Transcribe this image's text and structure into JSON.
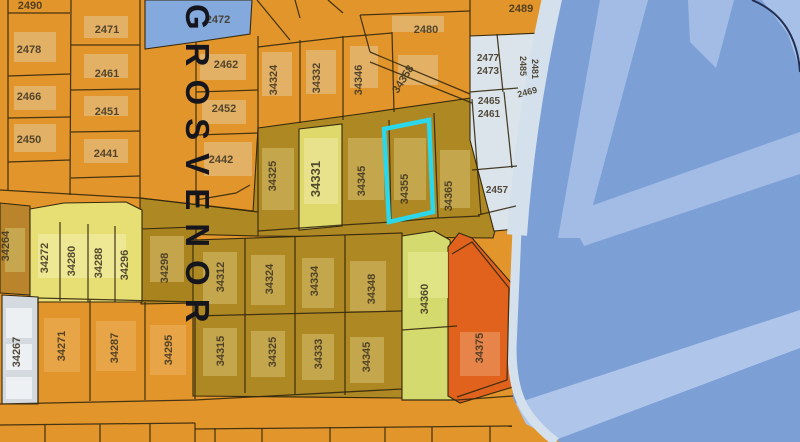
{
  "map": {
    "title": "Parcel map with selected parcel 34355",
    "selected_parcel": "34355",
    "highlight": {
      "points": "384,129 429,120 433,212 389,222",
      "color": "#2BD7EA",
      "width": 4.5
    },
    "street_label": {
      "text": "GROSVENOR",
      "x": 158,
      "y": 4,
      "size": 33
    },
    "colors": {
      "water": "#7CA0D6",
      "road_light": "#D4E1ED",
      "band": "#A2BCE6",
      "band2": "#AFC6EA",
      "orange": "#E2952A",
      "olive": "#AE8822",
      "olive_dark": "#A9831E",
      "brown": "#B9842B",
      "yellow": "#E7DF74",
      "yellow2": "#DFD96B",
      "yellow_green": "#D5DA6F",
      "red": "#E0621C",
      "light_parcel": "#DBE4EB",
      "gray_parcel": "#D5DAE0",
      "blue_parcel": "#84A9DC",
      "line": "#35290F"
    },
    "regions": [
      {
        "name": "region-water",
        "points": "0,0 800,0 800,442 0,442",
        "fill": "#7CA0D6",
        "stroke": "none"
      },
      {
        "name": "highway-band",
        "points": "600,0 648,0 584,238 558,238",
        "fill": "#A2BCE6",
        "stroke": "none"
      },
      {
        "name": "highway-band",
        "points": "800,132 800,174 584,246 568,214",
        "fill": "#A2BCE6",
        "stroke": "none"
      },
      {
        "name": "highway-band",
        "points": "688,0 734,0 716,68 690,42",
        "fill": "#A2BCE6",
        "stroke": "none"
      },
      {
        "name": "highway-band",
        "points": "762,0 800,0 800,70 788,34",
        "fill": "#A6C0E8",
        "stroke": "none"
      },
      {
        "name": "highway-band",
        "points": "514,404 800,310 800,348 550,442 518,430",
        "fill": "#AFC6EA",
        "stroke": "none"
      },
      {
        "name": "region-land",
        "points": "0,0 550,0 542,35 520,180 514,255 510,345 513,398 526,424 560,442 0,442",
        "fill": "#E2952A",
        "stroke": "none"
      },
      {
        "name": "region-olive-row",
        "points": "258,128 360,114 478,97 500,213 493,238 258,236 253,212",
        "fill": "#AE8822",
        "stroke": "#35290F"
      },
      {
        "name": "region-olive-street",
        "points": "140,198 258,212 258,236 140,233",
        "fill": "#AE8822",
        "stroke": "#35290F"
      },
      {
        "name": "region-parcel-34264",
        "points": "0,203 30,206 30,295 0,293",
        "fill": "#B9842B",
        "stroke": "#35290F"
      },
      {
        "name": "region-parcel-34298",
        "points": "141,229 196,227 196,303 141,304",
        "fill": "#A9831E",
        "stroke": "#35290F"
      },
      {
        "name": "region-olive-block",
        "points": "193,240 402,233 402,398 193,396",
        "fill": "#AE8822",
        "stroke": "#35290F"
      },
      {
        "name": "region-yellow-block",
        "points": "30,209 64,203 126,202 142,210 142,302 30,302",
        "fill": "#E7DF74",
        "stroke": "#35290F"
      },
      {
        "name": "region-parcel-34331",
        "points": "299,129 342,124 342,226 299,230",
        "fill": "#DFD96B",
        "stroke": "#35290F"
      },
      {
        "name": "region-parcel-34360",
        "points": "402,236 434,231 450,240 457,316 457,400 402,400",
        "fill": "#D5DA6F",
        "stroke": "#35290F"
      },
      {
        "name": "region-parcel-34375",
        "points": "448,247 459,233 472,238 513,285 517,320 513,387 460,403 448,396",
        "fill": "#E0621C",
        "stroke": "#35290F"
      },
      {
        "name": "region-light-parcels",
        "points": "470,36 543,33 520,180 516,229 494,231 470,140",
        "fill": "#DBE4EB",
        "stroke": "#35290F"
      },
      {
        "name": "region-parcel-2472",
        "points": "145,0 252,0 250,34 196,42 145,49",
        "fill": "#84A9DC",
        "stroke": "#35290F"
      },
      {
        "name": "region-parcel-34267",
        "points": "2,295 38,297 38,404 2,404",
        "fill": "#D5DAE0",
        "stroke": "#35290F"
      }
    ],
    "road_strokes": [
      {
        "name": "road-edge-upper",
        "d": "M 553,-6 C 536,70 523,150 517,235",
        "stroke": "#D4E1ED",
        "width": 20
      },
      {
        "name": "road-edge-lower",
        "d": "M 517,230 L 512,348 C 512,392 522,416 556,442",
        "stroke": "#D4E1ED",
        "width": 9
      },
      {
        "name": "ramp-arc",
        "d": "M 752,0 Q 796,18 800,72",
        "stroke": "#232E52",
        "width": 2
      }
    ],
    "buildings": [
      {
        "x": 14,
        "y": 32,
        "w": 42,
        "h": 30,
        "fill": "#E4B671"
      },
      {
        "x": 14,
        "y": 86,
        "w": 42,
        "h": 24,
        "fill": "#E4B671"
      },
      {
        "x": 14,
        "y": 124,
        "w": 42,
        "h": 28,
        "fill": "#E4B671"
      },
      {
        "x": 84,
        "y": 16,
        "w": 44,
        "h": 22,
        "fill": "#E4B671"
      },
      {
        "x": 84,
        "y": 54,
        "w": 44,
        "h": 24,
        "fill": "#E4B671"
      },
      {
        "x": 84,
        "y": 96,
        "w": 44,
        "h": 20,
        "fill": "#E4B671"
      },
      {
        "x": 84,
        "y": 139,
        "w": 44,
        "h": 24,
        "fill": "#E4B671"
      },
      {
        "x": 200,
        "y": 54,
        "w": 46,
        "h": 26,
        "fill": "#E4B671"
      },
      {
        "x": 202,
        "y": 100,
        "w": 44,
        "h": 24,
        "fill": "#E4B671"
      },
      {
        "x": 204,
        "y": 142,
        "w": 48,
        "h": 34,
        "fill": "#E4B671"
      },
      {
        "x": 262,
        "y": 52,
        "w": 30,
        "h": 44,
        "fill": "#E4B671"
      },
      {
        "x": 306,
        "y": 50,
        "w": 30,
        "h": 44,
        "fill": "#E4B671"
      },
      {
        "x": 350,
        "y": 46,
        "w": 28,
        "h": 42,
        "fill": "#E4B671"
      },
      {
        "x": 398,
        "y": 55,
        "w": 40,
        "h": 30,
        "fill": "#E4B671"
      },
      {
        "x": 392,
        "y": 16,
        "w": 52,
        "h": 16,
        "fill": "#E4B671"
      },
      {
        "x": 44,
        "y": 318,
        "w": 36,
        "h": 54,
        "fill": "#E9A84D"
      },
      {
        "x": 96,
        "y": 321,
        "w": 40,
        "h": 50,
        "fill": "#E9A84D"
      },
      {
        "x": 150,
        "y": 325,
        "w": 36,
        "h": 50,
        "fill": "#E9A84D"
      },
      {
        "x": 262,
        "y": 148,
        "w": 32,
        "h": 62,
        "fill": "#C9AC55"
      },
      {
        "x": 348,
        "y": 138,
        "w": 36,
        "h": 62,
        "fill": "#C9AC55"
      },
      {
        "x": 394,
        "y": 138,
        "w": 32,
        "h": 62,
        "fill": "#C9AC55"
      },
      {
        "x": 440,
        "y": 150,
        "w": 30,
        "h": 58,
        "fill": "#C9AC55"
      },
      {
        "x": 203,
        "y": 252,
        "w": 34,
        "h": 52,
        "fill": "#C9AC55"
      },
      {
        "x": 251,
        "y": 255,
        "w": 34,
        "h": 50,
        "fill": "#C9AC55"
      },
      {
        "x": 302,
        "y": 258,
        "w": 32,
        "h": 50,
        "fill": "#C9AC55"
      },
      {
        "x": 350,
        "y": 261,
        "w": 36,
        "h": 50,
        "fill": "#C9AC55"
      },
      {
        "x": 203,
        "y": 328,
        "w": 34,
        "h": 48,
        "fill": "#C9AC55"
      },
      {
        "x": 251,
        "y": 331,
        "w": 34,
        "h": 46,
        "fill": "#C9AC55"
      },
      {
        "x": 302,
        "y": 334,
        "w": 32,
        "h": 46,
        "fill": "#C9AC55"
      },
      {
        "x": 350,
        "y": 337,
        "w": 34,
        "h": 46,
        "fill": "#C9AC55"
      },
      {
        "x": 150,
        "y": 236,
        "w": 34,
        "h": 46,
        "fill": "#C9AC55"
      },
      {
        "x": 5,
        "y": 228,
        "w": 20,
        "h": 44,
        "fill": "#C9AC55"
      },
      {
        "x": 38,
        "y": 234,
        "w": 88,
        "h": 44,
        "fill": "#F0EA9A"
      },
      {
        "x": 304,
        "y": 138,
        "w": 34,
        "h": 66,
        "fill": "#EAE492"
      },
      {
        "x": 408,
        "y": 252,
        "w": 40,
        "h": 46,
        "fill": "#E3E68A"
      },
      {
        "x": 460,
        "y": 332,
        "w": 40,
        "h": 44,
        "fill": "#E98A52"
      },
      {
        "x": 6,
        "y": 308,
        "w": 26,
        "h": 30,
        "fill": "#F2F5F7"
      },
      {
        "x": 6,
        "y": 344,
        "w": 26,
        "h": 26,
        "fill": "#F2F5F7"
      },
      {
        "x": 6,
        "y": 377,
        "w": 26,
        "h": 22,
        "fill": "#F2F5F7"
      }
    ],
    "lines": [
      {
        "pts": "8,0 8,190"
      },
      {
        "pts": "71,0 70,195"
      },
      {
        "pts": "140,0 140,198"
      },
      {
        "pts": "8,13 70,13"
      },
      {
        "pts": "8,76 70,74"
      },
      {
        "pts": "8,118 70,117"
      },
      {
        "pts": "8,162 70,160"
      },
      {
        "pts": "71,45 140,45"
      },
      {
        "pts": "71,90 140,89"
      },
      {
        "pts": "71,132 140,131"
      },
      {
        "pts": "71,178 140,176"
      },
      {
        "pts": "0,190 140,198"
      },
      {
        "pts": "140,198 253,211"
      },
      {
        "pts": "196,42 196,205"
      },
      {
        "pts": "258,36 258,212"
      },
      {
        "pts": "196,92 258,90"
      },
      {
        "pts": "196,135 258,133"
      },
      {
        "pts": "196,200 236,193 250,185"
      },
      {
        "pts": "300,40 300,123"
      },
      {
        "pts": "343,36 343,120"
      },
      {
        "pts": "392,32 394,112"
      },
      {
        "pts": "258,47 300,42 343,37 392,33"
      },
      {
        "pts": "257,0 290,40"
      },
      {
        "pts": "295,0 300,18"
      },
      {
        "pts": "328,0 343,13"
      },
      {
        "pts": "370,52 470,94"
      },
      {
        "pts": "370,62 472,103"
      },
      {
        "pts": "360,15 470,11"
      },
      {
        "pts": "360,15 370,52"
      },
      {
        "pts": "470,0 470,36"
      },
      {
        "pts": "389,120 391,222"
      },
      {
        "pts": "434,113 438,218"
      },
      {
        "pts": "472,99 481,215"
      },
      {
        "pts": "258,231 343,225 392,222 436,218 480,216"
      },
      {
        "pts": "60,222 60,301"
      },
      {
        "pts": "88,224 88,302"
      },
      {
        "pts": "115,226 115,302"
      },
      {
        "pts": "245,238 245,393"
      },
      {
        "pts": "295,236 295,394"
      },
      {
        "pts": "345,235 345,395"
      },
      {
        "pts": "193,316 402,311"
      },
      {
        "pts": "38,298 38,403"
      },
      {
        "pts": "90,300 90,401"
      },
      {
        "pts": "145,302 145,400"
      },
      {
        "pts": "195,303 195,399"
      },
      {
        "pts": "38,298 195,302"
      },
      {
        "pts": "0,404 195,400"
      },
      {
        "pts": "195,400 402,389"
      },
      {
        "pts": "402,400 457,400 513,396"
      },
      {
        "pts": "0,425 195,423"
      },
      {
        "pts": "45,425 45,442"
      },
      {
        "pts": "100,424 100,442"
      },
      {
        "pts": "150,424 150,442"
      },
      {
        "pts": "195,423 195,442"
      },
      {
        "pts": "195,429 512,426"
      },
      {
        "pts": "215,428 215,442"
      },
      {
        "pts": "262,428 262,442"
      },
      {
        "pts": "330,427 330,442"
      },
      {
        "pts": "385,427 385,442"
      },
      {
        "pts": "432,427 432,442"
      },
      {
        "pts": "490,426 490,442"
      },
      {
        "pts": "452,254 472,242 509,288"
      },
      {
        "pts": "509,288 507,380"
      },
      {
        "pts": "507,380 457,397"
      },
      {
        "pts": "402,330 457,326"
      },
      {
        "pts": "470,92 518,88"
      },
      {
        "pts": "472,170 517,166"
      },
      {
        "pts": "478,215 516,206"
      },
      {
        "pts": "497,34 503,92"
      },
      {
        "pts": "504,92 512,168"
      }
    ],
    "labels": [
      {
        "text": "2490",
        "x": 30,
        "y": 9
      },
      {
        "text": "2471",
        "x": 107,
        "y": 33
      },
      {
        "text": "2478",
        "x": 29,
        "y": 53
      },
      {
        "text": "2462",
        "x": 226,
        "y": 68
      },
      {
        "text": "2461",
        "x": 107,
        "y": 77
      },
      {
        "text": "2466",
        "x": 29,
        "y": 100
      },
      {
        "text": "2452",
        "x": 224,
        "y": 112
      },
      {
        "text": "2451",
        "x": 107,
        "y": 115
      },
      {
        "text": "2450",
        "x": 29,
        "y": 143
      },
      {
        "text": "2442",
        "x": 221,
        "y": 163
      },
      {
        "text": "2441",
        "x": 106,
        "y": 157
      },
      {
        "text": "2472",
        "x": 218,
        "y": 23
      },
      {
        "text": "34324",
        "x": 277,
        "y": 80,
        "rot": -90
      },
      {
        "text": "34332",
        "x": 320,
        "y": 78,
        "rot": -90
      },
      {
        "text": "34346",
        "x": 362,
        "y": 80,
        "rot": -90
      },
      {
        "text": "34358",
        "x": 406,
        "y": 81,
        "rot": -58
      },
      {
        "text": "2480",
        "x": 426,
        "y": 33
      },
      {
        "text": "2489",
        "x": 521,
        "y": 12
      },
      {
        "text": "2477",
        "x": 488,
        "y": 61,
        "size": 10
      },
      {
        "text": "2473",
        "x": 488,
        "y": 74,
        "size": 10
      },
      {
        "text": "2485",
        "x": 520,
        "y": 66,
        "rot": 90,
        "size": 9
      },
      {
        "text": "2481",
        "x": 532,
        "y": 69,
        "rot": 90,
        "size": 9
      },
      {
        "text": "2469",
        "x": 528,
        "y": 95,
        "rot": -15,
        "size": 9
      },
      {
        "text": "2465",
        "x": 489,
        "y": 104,
        "size": 10
      },
      {
        "text": "2461",
        "x": 489,
        "y": 117,
        "size": 10
      },
      {
        "text": "2457",
        "x": 497,
        "y": 193,
        "size": 10
      },
      {
        "text": "34325",
        "x": 276,
        "y": 176,
        "rot": -90
      },
      {
        "text": "34331",
        "x": 320,
        "y": 179,
        "rot": -90,
        "size": 13
      },
      {
        "text": "34345",
        "x": 365,
        "y": 181,
        "rot": -90
      },
      {
        "text": "34355",
        "x": 408,
        "y": 189,
        "rot": -90
      },
      {
        "text": "34365",
        "x": 452,
        "y": 196,
        "rot": -90
      },
      {
        "text": "34264",
        "x": 9,
        "y": 246,
        "rot": -90
      },
      {
        "text": "34272",
        "x": 48,
        "y": 258,
        "rot": -90
      },
      {
        "text": "34280",
        "x": 75,
        "y": 261,
        "rot": -90
      },
      {
        "text": "34288",
        "x": 102,
        "y": 263,
        "rot": -90
      },
      {
        "text": "34296",
        "x": 128,
        "y": 265,
        "rot": -90
      },
      {
        "text": "34298",
        "x": 168,
        "y": 268,
        "rot": -90
      },
      {
        "text": "34312",
        "x": 224,
        "y": 277,
        "rot": -90
      },
      {
        "text": "34324",
        "x": 273,
        "y": 279,
        "rot": -90
      },
      {
        "text": "34334",
        "x": 318,
        "y": 281,
        "rot": -90
      },
      {
        "text": "34348",
        "x": 375,
        "y": 289,
        "rot": -90
      },
      {
        "text": "34360",
        "x": 428,
        "y": 299,
        "rot": -90
      },
      {
        "text": "34267",
        "x": 20,
        "y": 352,
        "rot": -90
      },
      {
        "text": "34271",
        "x": 65,
        "y": 346,
        "rot": -90
      },
      {
        "text": "34287",
        "x": 118,
        "y": 348,
        "rot": -90
      },
      {
        "text": "34295",
        "x": 172,
        "y": 350,
        "rot": -90
      },
      {
        "text": "34315",
        "x": 224,
        "y": 351,
        "rot": -90
      },
      {
        "text": "34325",
        "x": 276,
        "y": 352,
        "rot": -90
      },
      {
        "text": "34333",
        "x": 322,
        "y": 354,
        "rot": -90
      },
      {
        "text": "34345",
        "x": 370,
        "y": 357,
        "rot": -90
      },
      {
        "text": "34375",
        "x": 483,
        "y": 348,
        "rot": -90
      }
    ]
  }
}
